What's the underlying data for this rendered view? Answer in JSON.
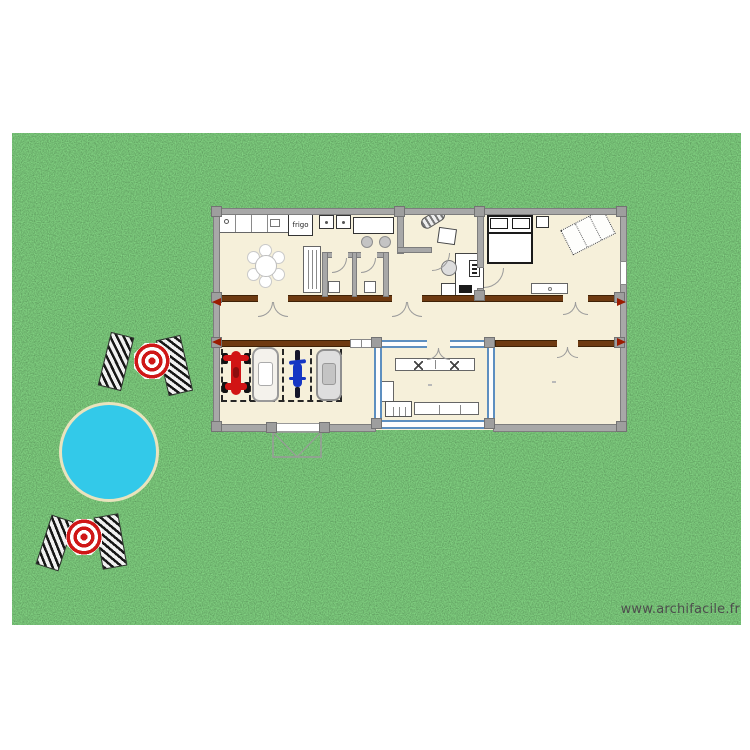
{
  "watermark": "www.archifacile.fr",
  "labels": {
    "fridge": "frigo"
  },
  "colors": {
    "grass_base": "#4a9d4a",
    "floor": "#f6f0da",
    "wall": "#a8a8a8",
    "wall_edge": "#7d7d7d",
    "wood_wall": "#6e3a11",
    "veranda_wall": "#5d8fc0",
    "pool_water": "#33c9e9",
    "pool_edge": "#e9e3bd",
    "umbrella_red": "#cf1717",
    "quad_red": "#d11414",
    "bike_blue": "#1536c4",
    "watermark_color": "#4d4d4d"
  },
  "scene_objects": [
    "grass-lawn",
    "round-pool",
    "sun-umbrella",
    "sun-lounger",
    "house-floor-plan",
    "kitchen-counter",
    "fridge",
    "stove-burners",
    "bar-table",
    "bar-stool",
    "tall-cabinet",
    "round-dining-table",
    "wc-room",
    "office-desk",
    "office-chair",
    "computer-tower",
    "keyboard",
    "side-table",
    "decor-item",
    "double-bed",
    "nightstand",
    "rug",
    "dresser",
    "window",
    "corridor",
    "interior-door",
    "entrance-arrow",
    "garage",
    "parking-bay",
    "quad-bike",
    "car",
    "motorcycle",
    "garage-door",
    "veranda",
    "wardrobe",
    "laundry-machine",
    "counter-unit",
    "terrace-room"
  ]
}
